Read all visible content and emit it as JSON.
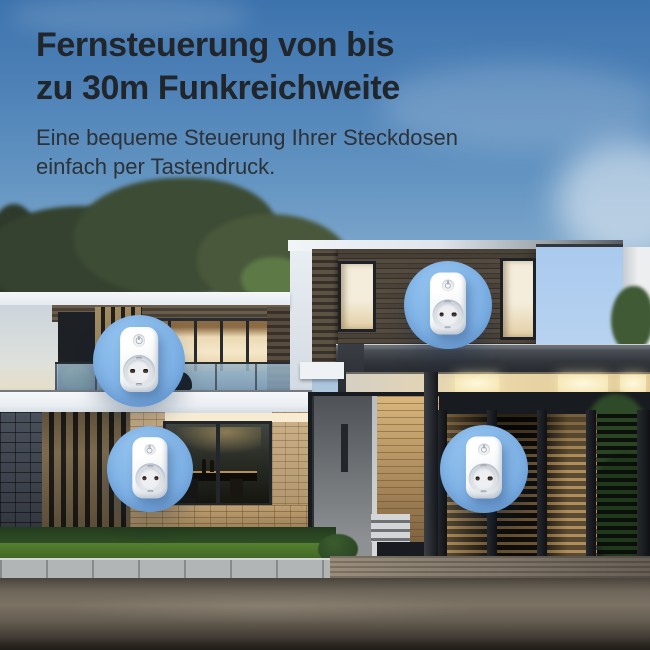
{
  "header": {
    "title_line1": "Fernsteuerung von bis",
    "title_line2": "zu 30m Funkreichweite",
    "subtitle_line1": "Eine bequeme Steuerung Ihrer Steckdosen",
    "subtitle_line2": "einfach per Tastendruck."
  },
  "callouts": [
    {
      "icon": "smart-plug-icon"
    },
    {
      "icon": "smart-plug-icon"
    },
    {
      "icon": "smart-plug-icon"
    },
    {
      "icon": "smart-plug-icon"
    }
  ],
  "colors": {
    "headline_text": "#20262b",
    "subtitle_text": "#2c3238",
    "callout_circle_blue": "#7eb1e5",
    "plug_body_white": "#f4f6f8",
    "sky_top": "#3d73ad",
    "sky_horizon": "#e4ebf1"
  }
}
